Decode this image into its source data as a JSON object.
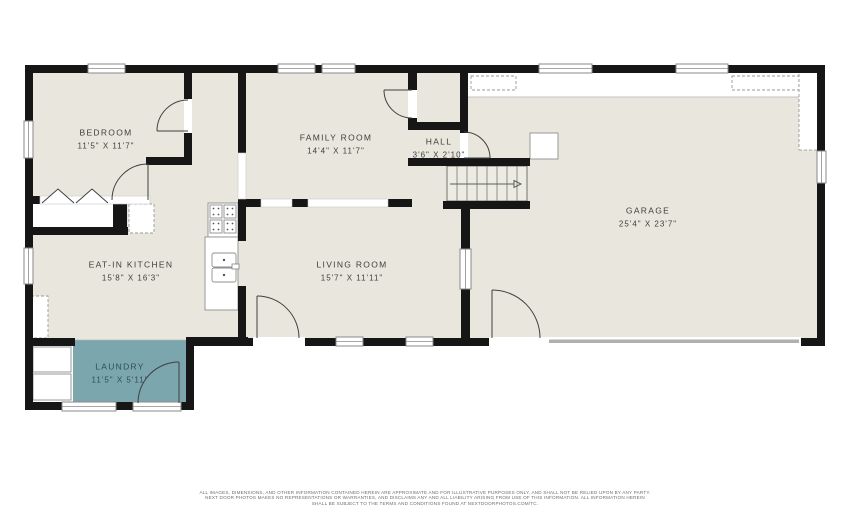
{
  "rooms": {
    "bedroom": {
      "name": "BEDROOM",
      "dims": "11'5\" X 11'7\""
    },
    "family_room": {
      "name": "FAMILY ROOM",
      "dims": "14'4\" X 11'7\""
    },
    "hall": {
      "name": "HALL",
      "dims": "3'6\" X 2'10\""
    },
    "garage": {
      "name": "GARAGE",
      "dims": "25'4\" X 23'7\""
    },
    "kitchen": {
      "name": "EAT-IN KITCHEN",
      "dims": "15'8\" X 16'3\""
    },
    "living_room": {
      "name": "LIVING ROOM",
      "dims": "15'7\" X 11'11\""
    },
    "laundry": {
      "name": "LAUNDRY",
      "dims": "11'5\" X 5'11\""
    }
  },
  "fixtures": {
    "stove": "stove-4-burner-icon",
    "sink": "double-basin-sink-icon",
    "refrigerator": "dashed-appliance-icon",
    "washer_dryer": "washer-dryer-icon",
    "stairs": "staircase-up-arrow-icon",
    "bifold_closet": "bifold-door-icon",
    "garage_door": "garage-door-opening"
  },
  "colors": {
    "wall": "#161616",
    "floor": "#e9e7dd",
    "laundry": "#7ba6ae",
    "background": "#ffffff",
    "door_line": "#3f4040"
  },
  "disclaimer": [
    "ALL IMAGES, DIMENSIONS, AND OTHER INFORMATION CONTAINED HEREIN ARE APPROXIMATE AND FOR ILLUSTRATIVE PURPOSES ONLY, AND SHALL NOT BE RELIED UPON BY ANY PARTY.",
    "NEXT DOOR PHOTOS MAKES NO REPRESENTATIONS OR WARRANTIES, AND DISCLAIMS ANY AND ALL LIABILITY ARISING FROM USE OF THIS INFORMATION. ALL INFORMATION HEREIN",
    "SHALL BE SUBJECT TO THE TERMS AND CONDITIONS FOUND AT NEXTDOORPHOTOS.COM/TC."
  ]
}
